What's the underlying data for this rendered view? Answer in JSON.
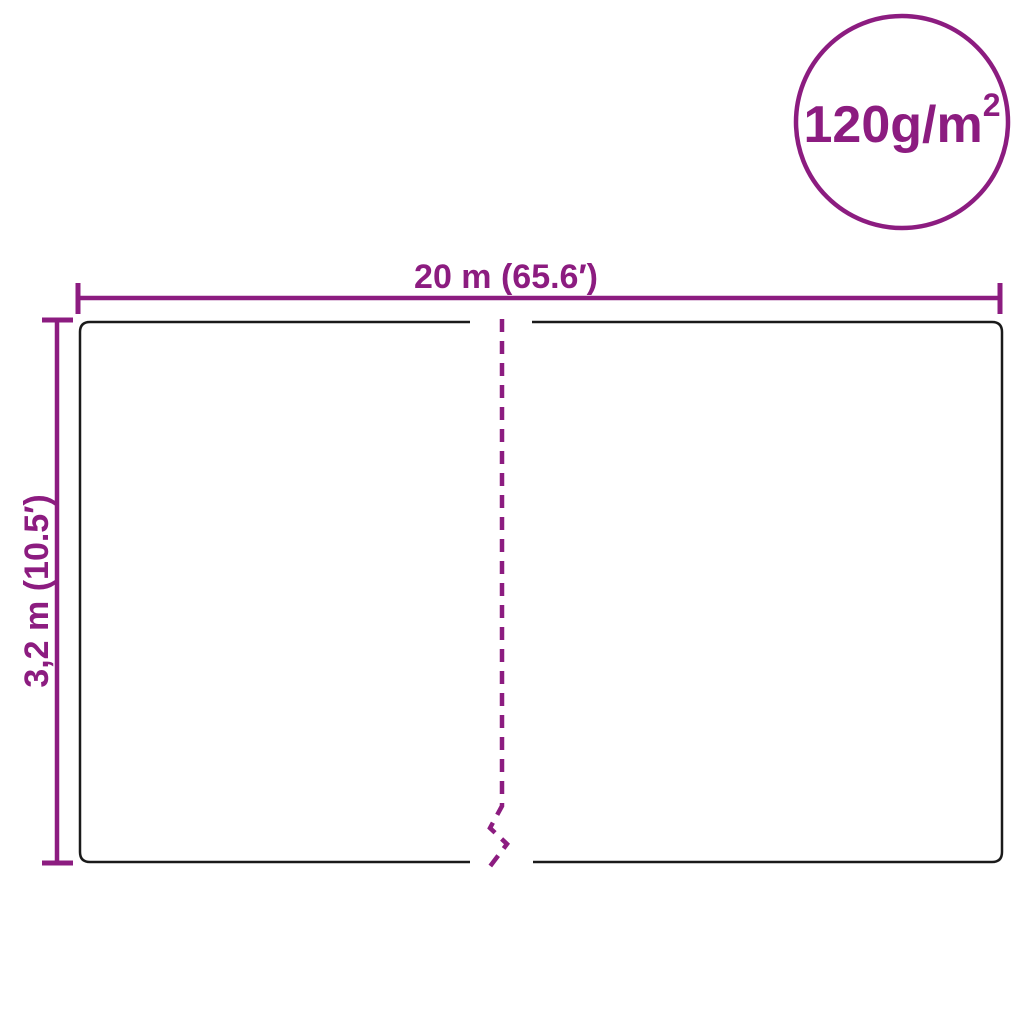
{
  "diagram": {
    "badge": {
      "text": "120g/m",
      "superscript": "2"
    },
    "width_dimension": {
      "label": "20 m (65.6′)"
    },
    "height_dimension": {
      "label": "3,2 m (10.5′)"
    }
  },
  "colors": {
    "accent": "#8C1C80",
    "outline": "#1A1A1A",
    "background": "#FFFFFF"
  }
}
